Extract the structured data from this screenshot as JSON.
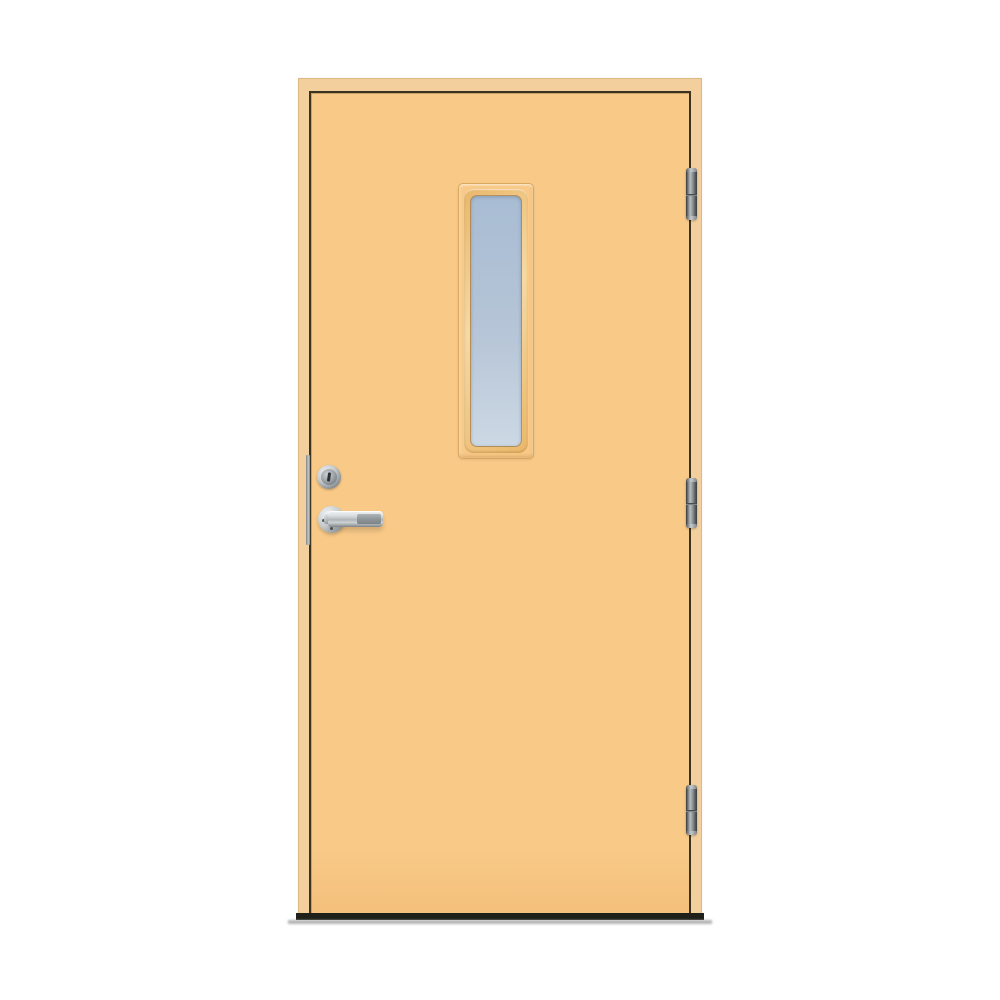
{
  "scene": {
    "type": "product-photo",
    "subject": "Exterior door with narrow vertical glazing strip, chrome lever handle, lock cylinder and three barrel hinges",
    "background": "white studio background",
    "door_swing": "right-hinged, handle on left",
    "hinge_count": 3,
    "window_count": 1,
    "text_content": ""
  },
  "colors": {
    "page-bg": "#ffffff",
    "frame": "#f2cf9d",
    "door": "#f8c987",
    "gap": "#3a3322",
    "molding-edge": "#d9a85c",
    "molding-hi": "#f7d9a2",
    "molding-lo": "#e9b76a",
    "glass-top": "#a8bcd3",
    "glass-mid": "#b6c5d7",
    "glass-bottom": "#ccd8e4",
    "hinge-dark": "#3f4345",
    "hinge-mid": "#8b9194",
    "hinge-light": "#b7bcbf",
    "chrome-light": "#f2f4f5",
    "chrome-mid": "#c3c8cb",
    "chrome-dark": "#7d8487",
    "threshold": "#20201a",
    "threshold-shadow": "#a3a3a3"
  }
}
